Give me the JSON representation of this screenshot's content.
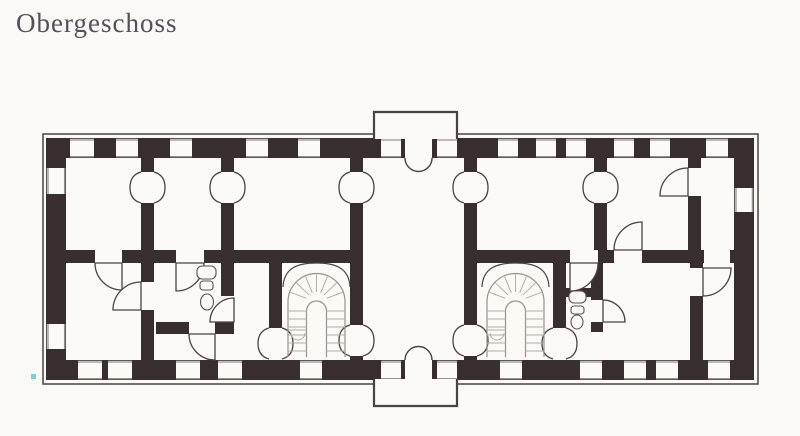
{
  "title": "Obergeschoss",
  "plan": {
    "kind": "scanned architectural floor plan",
    "floor_label": "Obergeschoss",
    "staircase_count": 2,
    "stair_style": "U-shaped winder stairs under arched openings, flanking central hall",
    "balcony_count": 2,
    "balcony_positions": [
      "top center",
      "bottom center"
    ],
    "window_counts": {
      "top_wall": 13,
      "bottom_wall": 12,
      "left_wall": 2,
      "right_wall": 1
    },
    "colors": {
      "paper": "#fbfaf7",
      "wall": "#382e30",
      "line": "#4a4244",
      "sill": "#98928c",
      "stair_line": "#b6aea3",
      "stair_outline": "#9a938a",
      "title_text": "#51505b",
      "artifact": "#7ecfe0"
    }
  }
}
